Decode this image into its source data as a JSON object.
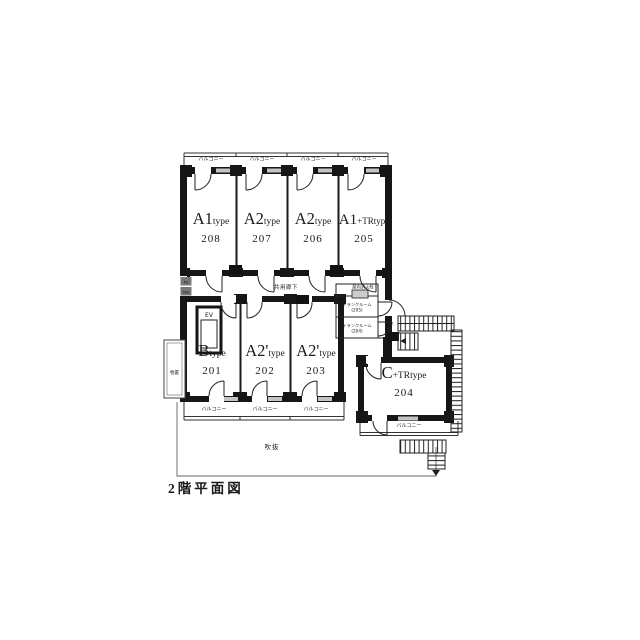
{
  "title": "2階平面図",
  "units": [
    {
      "main": "A1",
      "sub": "type",
      "number": "208"
    },
    {
      "main": "A2",
      "sub": "type",
      "number": "207"
    },
    {
      "main": "A2",
      "sub": "type",
      "number": "206"
    },
    {
      "main": "A1",
      "sub": "+TRtype",
      "number": "205"
    },
    {
      "main": "B",
      "sub": "type",
      "number": "201"
    },
    {
      "main": "A2'",
      "sub": "type",
      "number": "202"
    },
    {
      "main": "A2'",
      "sub": "type",
      "number": "203"
    },
    {
      "main": "C",
      "sub": "+TRtype",
      "number": "204"
    }
  ],
  "labels": {
    "balcony": "バルコニー",
    "corridor": "共用廊下",
    "elevator": "EV",
    "trunk_room": "トランクルーム",
    "trunk_no_205": "(205)",
    "trunk_no_204": "(204)",
    "hydrant": "屋内消火栓",
    "void_area": "吹抜",
    "storage": "物置",
    "meter_box": "MB",
    "pipe_space": "PS"
  },
  "colors": {
    "wall": "#161616",
    "line": "#222222",
    "roof_outline": "#999999",
    "window": "#c4c4c4"
  }
}
